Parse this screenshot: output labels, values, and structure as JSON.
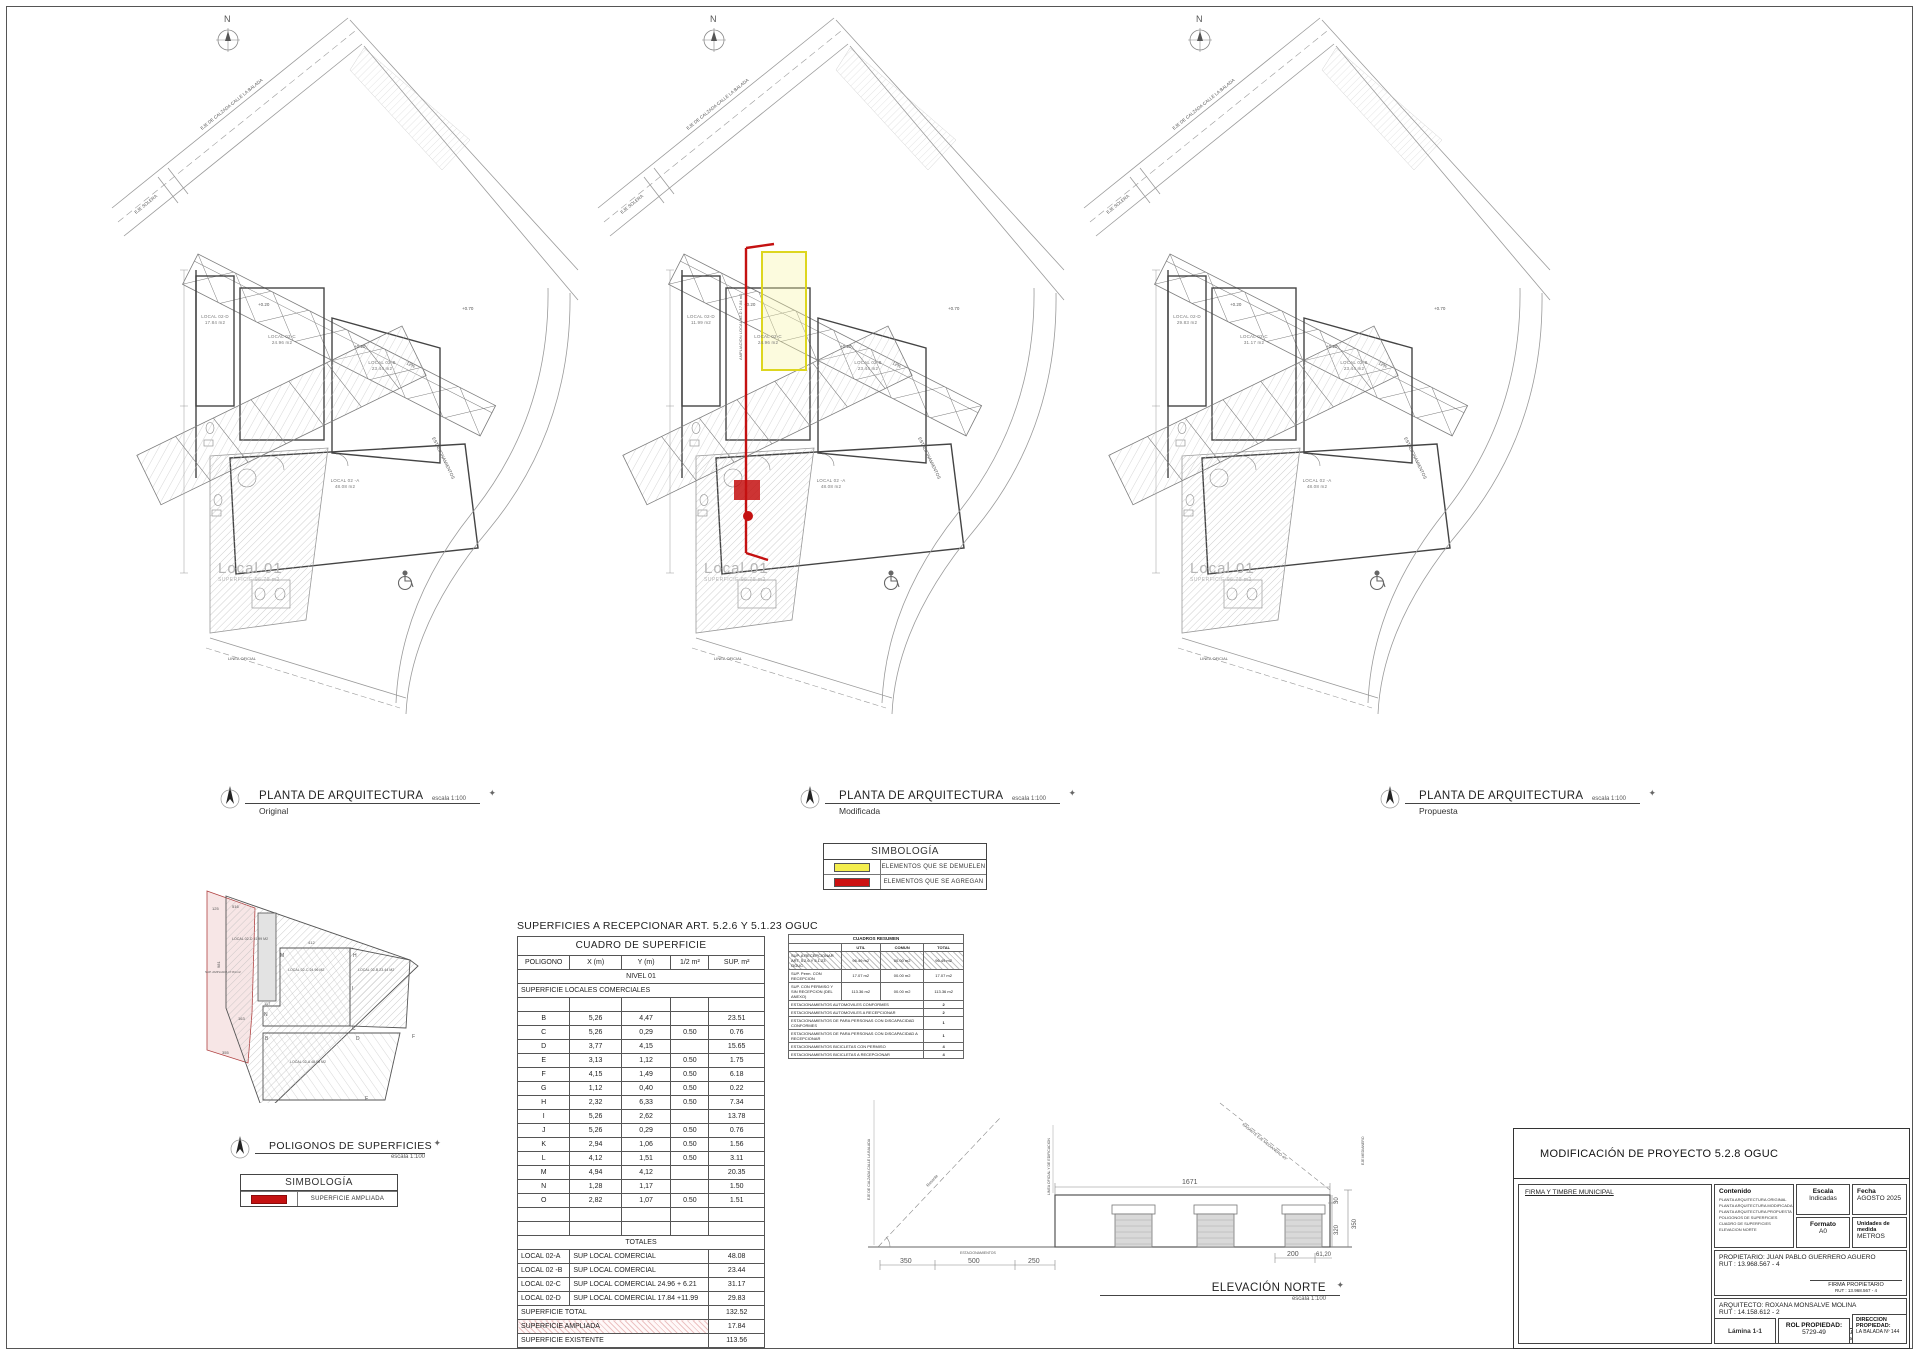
{
  "plan_common": {
    "north": "N",
    "street1": "EJE DE CALZADA CALLE LA BALADA",
    "street2": "EJE SOLERA",
    "linea_oficial": "LINEA OFICIAL",
    "estacionamientos": "ESTACIONAMIENTOS",
    "level_a": "+0.20",
    "level_b": "+0.20",
    "level_c": "+0.70",
    "ramp": "12%",
    "local01": "Local 01",
    "local01_sup": "SUPERFICIE 96.70 m2"
  },
  "plans": [
    {
      "title": "PLANTA DE ARQUITECTURA",
      "subtitle": "Original",
      "scale": "escala 1:100",
      "rooms": {
        "d1": "LOCAL 02-D",
        "d2": "17.84 m2",
        "c1": "LOCAL 02-C",
        "c2": "24.96 m2",
        "b1": "LOCAL 02-B",
        "b2": "23.44 m2",
        "a1": "LOCAL 02 -A",
        "a2": "48.08 m2"
      }
    },
    {
      "title": "PLANTA DE ARQUITECTURA",
      "subtitle": "Modificada",
      "scale": "escala 1:100",
      "amp_label": "AMPLIACION LOCAL 02-D 17.84 m2",
      "rooms": {
        "d1": "LOCAL 02-D",
        "d2": "11.99 m2",
        "c1": "LOCAL 02-C",
        "c2": "24.96 m2",
        "b1": "LOCAL 02-B",
        "b2": "23.44 m2",
        "a1": "LOCAL 02 -A",
        "a2": "48.08 m2"
      }
    },
    {
      "title": "PLANTA DE ARQUITECTURA",
      "subtitle": "Propuesta",
      "scale": "escala 1:100",
      "rooms": {
        "d1": "LOCAL 02-D",
        "d2": "29.83 m2",
        "c1": "LOCAL 02-C",
        "c2": "31.17 m2",
        "b1": "LOCAL 02-B",
        "b2": "23.44 m2",
        "a1": "LOCAL 02 -A",
        "a2": "48.08 m2"
      }
    }
  ],
  "symbology_mod": {
    "title": "SIMBOLOGÍA",
    "items": [
      {
        "color": "#f4ee4e",
        "label": "ELEMENTOS QUE SE DEMUELEN"
      },
      {
        "color": "#cc1111",
        "label": "ELEMENTOS QUE SE AGREGAN"
      }
    ]
  },
  "poligonos": {
    "title": "POLIGONOS DE SUPERFICIES",
    "scale": "escala 1:100",
    "symb_title": "SIMBOLOGÍA",
    "symb_label": "SUPERFICIE AMPLIADA",
    "room_d": "LOCAL 02-D 11.99 M2",
    "room_c": "LOCAL 02-C 24.96 M2",
    "room_b": "LOCAL 02-B 23.44 M2",
    "room_a": "LOCAL 02-A 48.08 M2",
    "amp": "SUP. AMPLIADA 17.84 m2",
    "note": "SUPERFICIE SE ACOGE A RECEPCION PARCIAL ARTICULO 5.2.6 Y 5.1.23 O.G.U.C.",
    "letters": [
      "M",
      "N",
      "B",
      "C",
      "D",
      "E",
      "F",
      "H",
      "I"
    ],
    "dims": [
      "125",
      "516",
      "412",
      "981",
      "163",
      "355",
      "117"
    ]
  },
  "surface_table": {
    "page_title": "SUPERFICIES A  RECEPCIONAR ART. 5.2.6 Y 5.1.23 OGUC",
    "header": "CUADRO DE SUPERFICIE",
    "cols": [
      "POLIGONO",
      "X (m)",
      "Y (m)",
      "1/2 m²",
      "SUP. m²"
    ],
    "nivel": "NIVEL 01",
    "group": "SUPERFICIE LOCALES COMERCIALES",
    "rows": [
      {
        "p": "B",
        "x": "5,26",
        "y": "4,47",
        "h": "",
        "s": "23.51"
      },
      {
        "p": "C",
        "x": "5,26",
        "y": "0,29",
        "h": "0.50",
        "s": "0.76"
      },
      {
        "p": "D",
        "x": "3,77",
        "y": "4,15",
        "h": "",
        "s": "15.65"
      },
      {
        "p": "E",
        "x": "3,13",
        "y": "1,12",
        "h": "0.50",
        "s": "1.75"
      },
      {
        "p": "F",
        "x": "4,15",
        "y": "1,49",
        "h": "0.50",
        "s": "6.18"
      },
      {
        "p": "G",
        "x": "1,12",
        "y": "0,40",
        "h": "0.50",
        "s": "0.22"
      },
      {
        "p": "H",
        "x": "2,32",
        "y": "6,33",
        "h": "0.50",
        "s": "7.34"
      },
      {
        "p": "I",
        "x": "5,26",
        "y": "2,62",
        "h": "",
        "s": "13.78"
      },
      {
        "p": "J",
        "x": "5,26",
        "y": "0,29",
        "h": "0.50",
        "s": "0.76"
      },
      {
        "p": "K",
        "x": "2,94",
        "y": "1,06",
        "h": "0.50",
        "s": "1.56"
      },
      {
        "p": "L",
        "x": "4,12",
        "y": "1,51",
        "h": "0.50",
        "s": "3.11"
      },
      {
        "p": "M",
        "x": "4,94",
        "y": "4,12",
        "h": "",
        "s": "20.35"
      },
      {
        "p": "N",
        "x": "1,28",
        "y": "1,17",
        "h": "",
        "s": "1.50"
      },
      {
        "p": "O",
        "x": "2,82",
        "y": "1,07",
        "h": "0.50",
        "s": "1.51"
      }
    ],
    "totales_header": "TOTALES",
    "totales": [
      {
        "c1": "LOCAL 02-A",
        "c2": "SUP LOCAL COMERCIAL",
        "c3": "48.08"
      },
      {
        "c1": "LOCAL 02 -B",
        "c2": "SUP LOCAL COMERCIAL",
        "c3": "23.44"
      },
      {
        "c1": "LOCAL 02-C",
        "c2": "SUP  LOCAL COMERCIAL    24.96 + 6.21",
        "c3": "31.17"
      },
      {
        "c1": "LOCAL 02-D",
        "c2": "SUP  LOCAL COMERCIAL    17.84 +11.99",
        "c3": "29.83"
      }
    ],
    "summary": [
      {
        "label": "SUPERFICIE TOTAL",
        "value": "132.52",
        "hatched": false
      },
      {
        "label": "SUPERFICIE AMPLIADA",
        "value": "17.84",
        "hatched": true
      },
      {
        "label": "SUPERFICIE EXISTENTE",
        "value": "113.56",
        "hatched": false
      }
    ]
  },
  "resumen_table": {
    "title": "CUADROS RESUMEN",
    "col_util": "UTIL",
    "col_comun": "COMUN",
    "col_total": "TOTAL",
    "sup_rows": [
      {
        "label": "SUP. A RECEPCIONAR ART. 5.2.6 Y 5.1.23 OGUC",
        "util": "96.49  m2",
        "comun": "00.00 m2",
        "total": "96.49  m2",
        "hatched": true
      },
      {
        "label": "SUP. Perm. CON RECEPCION",
        "util": "17.07  m2",
        "comun": "00.00 m2",
        "total": "17.07  m2",
        "hatched": false
      },
      {
        "label": "SUP. CON PERMISO Y SIN RECEPCION (DEL ANEXO)",
        "util": "113.36  m2",
        "comun": "00.00 m2",
        "total": "113.36  m2",
        "hatched": false
      }
    ],
    "park_rows": [
      {
        "label": "ESTACIONAMIENTOS  AUTOMOVILES CONFORMES",
        "value": "2"
      },
      {
        "label": "ESTACIONAMIENTOS  AUTOMOVILES A RECEPCIONAR",
        "value": "2"
      },
      {
        "label": "ESTACIONAMIENTOS DE PARA PERSONAS CON DISCAPACIDAD CONFORMES",
        "value": "1"
      },
      {
        "label": "ESTACIONAMIENTOS DE PARA PERSONAS CON DISCAPACIDAD  A RECEPCIONAR",
        "value": "1"
      },
      {
        "label": "ESTACIONAMIENTOS  BICICLETAS CON PERMISO",
        "value": "4"
      },
      {
        "label": "ESTACIONAMIENTOS  BICICLETAS A RECEPCIONAR",
        "value": "4"
      }
    ]
  },
  "elevation": {
    "title": "ELEVACIÓN NORTE",
    "scale": "escala 1:100",
    "dim_top": "1671",
    "dim_350l": "350",
    "dim_500": "500",
    "dim_250": "250",
    "dim_200": "200",
    "dim_6120": "61,20",
    "dim_30": "30",
    "dim_320": "320",
    "dim_350r": "350",
    "rasante": "Rasante",
    "estacionamientos": "ESTACIONAMIENTOS",
    "eje_calzada": "EJE DE CALZADA CALLE LA BALADA",
    "linea_oficial": "LINEA OFICIAL Y DE EDIFICACION",
    "rasante_medianero": "RASANTE EJE MEDIANERO 45°",
    "eje_medianero": "EJE MEDIANERO"
  },
  "titleblock": {
    "title": "MODIFICACIÓN DE PROYECTO 5.2.8 OGUC",
    "firma_municipal": "FIRMA Y TIMBRE MUNICIPAL",
    "contenido_label": "Contenido",
    "contenido_items": [
      "PLANTA ARQUITECTURA ORIGINAL",
      "PLANTA ARQUITECTURA MODIFICADA",
      "PLANTA ARQUITECTURA PROPUESTA",
      "POLIGONOS DE SUPERFICIES",
      "CUADRO DE SUPERFICIES",
      "ELEVACION NORTE"
    ],
    "escala_label": "Escala",
    "escala_value": "Indicadas",
    "fecha_label": "Fecha",
    "fecha_value": "AGOSTO 2025",
    "formato_label": "Formato",
    "formato_value": "A0",
    "unidades_label": "Unidades de medida",
    "unidades_value": "METROS",
    "propietario": "PROPIETARIO: JUAN PABLO GUERRERO AGUERO",
    "propietario_rut": "RUT : 13.968.567 - 4",
    "firma_propietario": "FIRMA  PROPIETARIO",
    "firma_propietario_rut": "RUT : 13.968.567 - 4",
    "arquitecto": "ARQUITECTO: ROXANA MONSALVE MOLINA",
    "arquitecto_rut": "RUT : 14.158.612 - 2",
    "firma_arquitecto": "FIRMA  ARQUITECTO",
    "patente": "Patente n° 3-1975",
    "lamina": "Lámina 1-1",
    "rol_label": "ROL PROPIEDAD:",
    "rol_value": "5729-49",
    "dir_label": "DIRECCION PROPIEDAD:",
    "dir_value": "LA BALADA Nº 144"
  }
}
